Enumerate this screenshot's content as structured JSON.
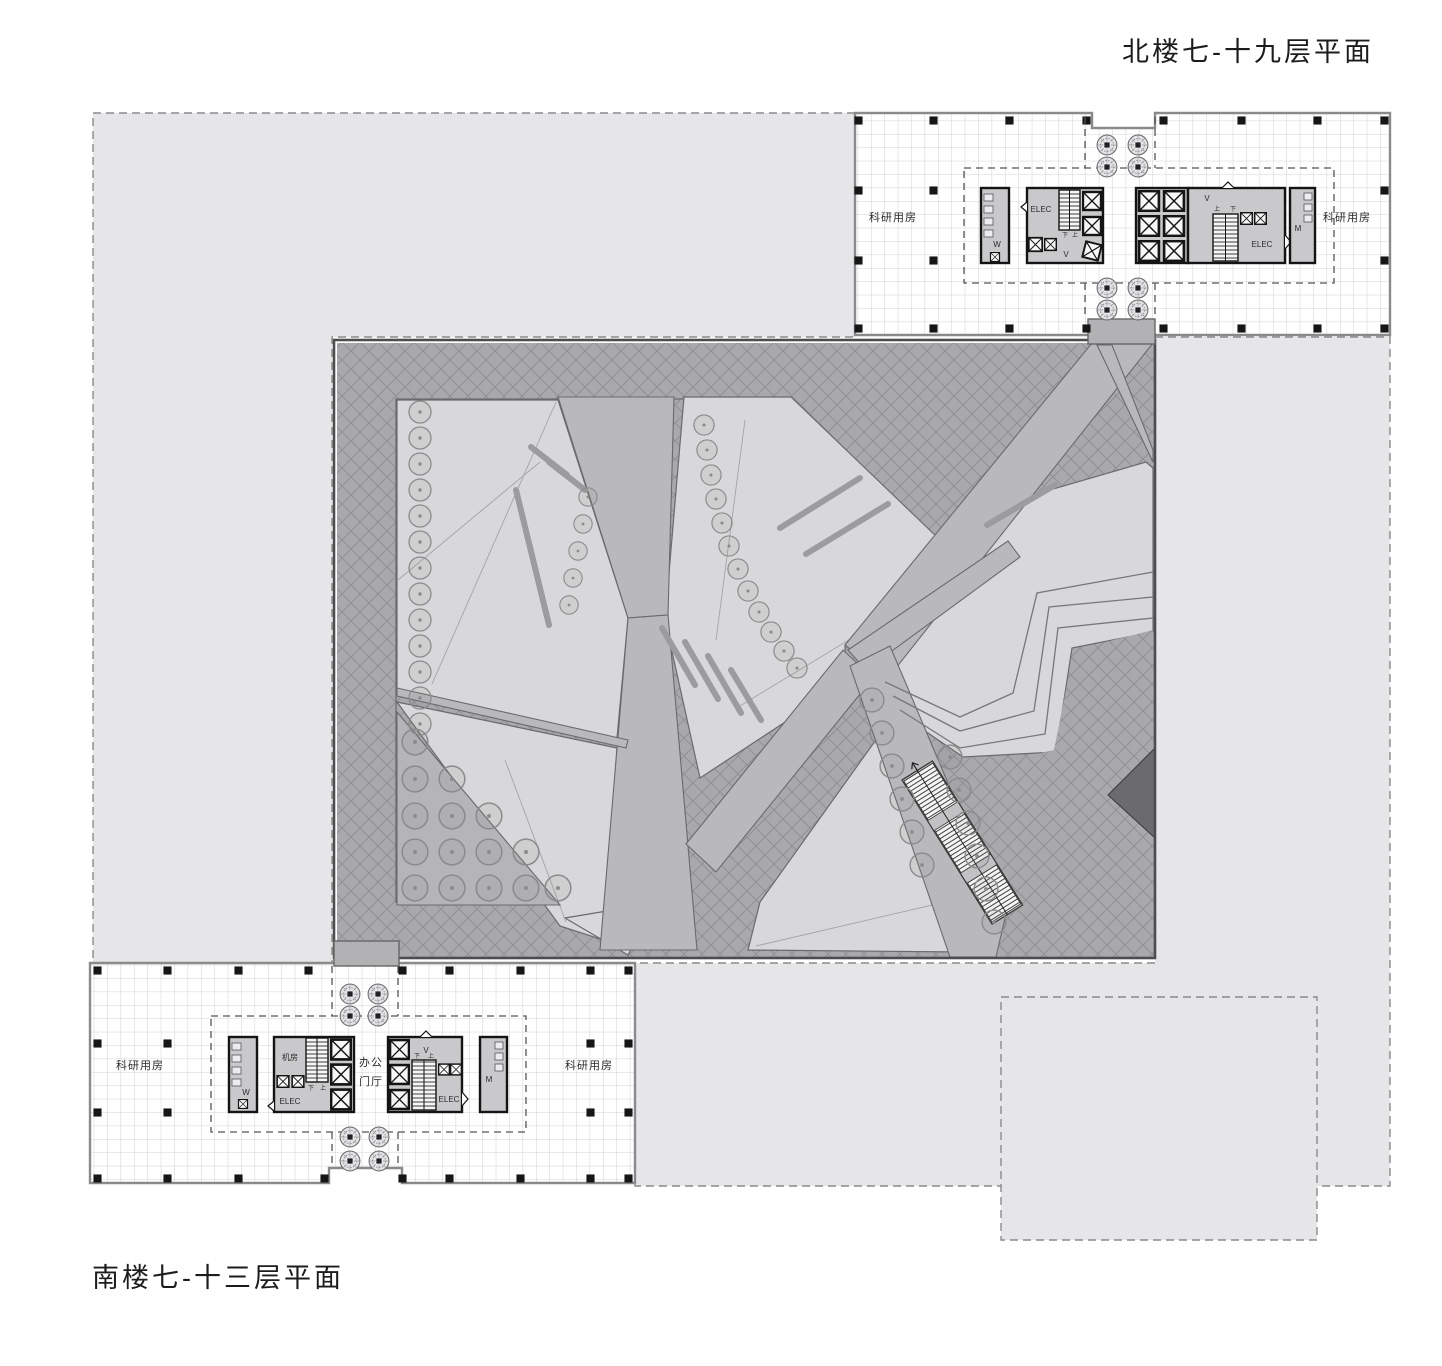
{
  "titles": {
    "north": "北楼七-十九层平面",
    "south": "南楼七-十三层平面"
  },
  "north_plan": {
    "research_left": "科研用房",
    "research_right": "科研用房",
    "core": {
      "elec_left": "ELEC",
      "elec_right": "ELEC",
      "women": "W",
      "men": "M",
      "vent_left": "V",
      "vent_right": "V",
      "up": "上",
      "down": "下"
    }
  },
  "south_plan": {
    "research_left": "科研用房",
    "research_right": "科研用房",
    "core": {
      "machine_room": "机房",
      "lobby_line1": "办公",
      "lobby_line2": "门厅",
      "elec_left": "ELEC",
      "elec_right": "ELEC",
      "women": "W",
      "men": "M",
      "vent": "V",
      "up": "上",
      "down": "下"
    }
  },
  "colors": {
    "site_fill": "#e6e6e8",
    "floor_fill": "#ffffff",
    "grid_line": "#c8c8ca",
    "building_wall": "#8a8a8c",
    "core_fill": "#c9c9cb",
    "core_wall": "#141414",
    "hatch_base": "#a9a9ab",
    "hatch_line": "#919193",
    "path_fill": "#b9b9bb",
    "garden_patch": "#d8d8da",
    "tree_cluster_zone": "#b5b5b7",
    "dark_ramp": "#6b6b6d",
    "column": "#161616",
    "dashed_boundary": "#8a8a8a"
  }
}
